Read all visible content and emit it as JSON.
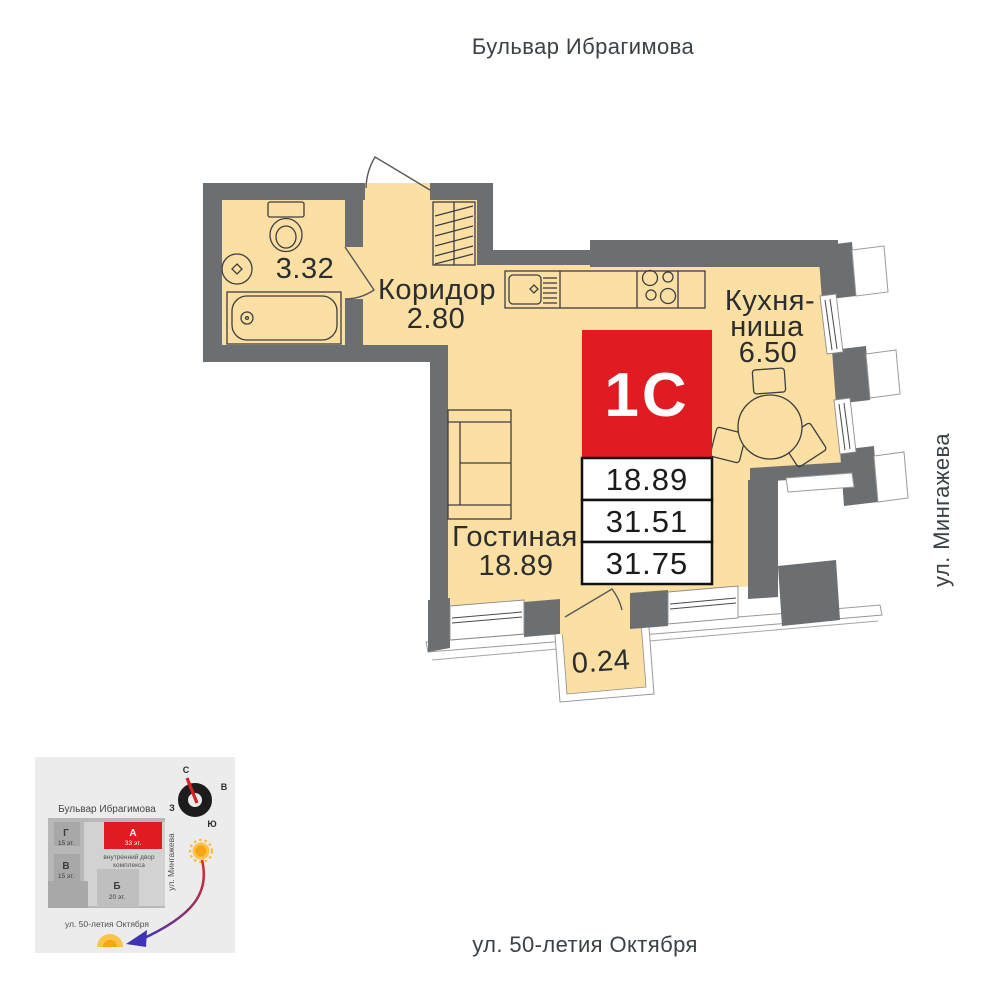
{
  "streets": {
    "top": "Бульвар Ибрагимова",
    "right": "ул. Мингажева",
    "bottom": "ул. 50-летия Октября"
  },
  "unit": {
    "type": "1С",
    "areas": {
      "room": "18.89",
      "apartment": "31.51",
      "total": "31.75"
    }
  },
  "rooms": {
    "bathroom": {
      "area": "3.32"
    },
    "corridor": {
      "label": "Коридор",
      "area": "2.80"
    },
    "kitchen": {
      "line1": "Кухня-",
      "line2": "ниша",
      "area": "6.50"
    },
    "living": {
      "label": "Гостиная",
      "area": "18.89"
    },
    "balcony": {
      "area": "0.24"
    }
  },
  "minimap": {
    "street_top": "Бульвар Ибрагимова",
    "street_side": "ул. Мингажева",
    "street_bottom": "ул. 50-летия Октября",
    "courtyard": {
      "line1": "внутренний двор",
      "line2": "комплекса"
    },
    "buildings": {
      "g": {
        "name": "Г",
        "floors": "15 эт."
      },
      "v": {
        "name": "В",
        "floors": "15 эт."
      },
      "a": {
        "name": "А",
        "floors": "33 эт."
      },
      "b": {
        "name": "Б",
        "floors": "20 эт."
      }
    },
    "compass": {
      "n": "С",
      "e": "В",
      "w": "З",
      "s": "Ю"
    }
  },
  "colors": {
    "wall": "#6c6f71",
    "floor": "#fbdfa3",
    "accent_red": "#e11b22",
    "minimap_bg": "#ececec",
    "sun": "#f6a516",
    "arrow_blue": "#3c34b3"
  }
}
